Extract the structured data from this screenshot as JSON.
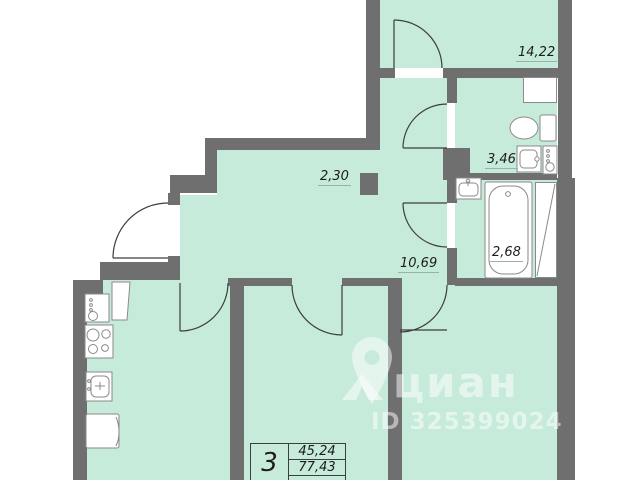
{
  "watermark": {
    "brand": "циан",
    "listing_id": "ID 325399024"
  },
  "labels": {
    "bedroom": "14,22",
    "corridor": "2,30",
    "wc": "3,46",
    "hall": "10,69",
    "bath": "2,68"
  },
  "stamp": {
    "rooms_count": "3",
    "row1": "45,24",
    "row2": "77,43"
  },
  "colors": {
    "room_fill": "#c7ebda",
    "wall": "#6f6f6f",
    "outline": "#3d3d3d",
    "fixture_stroke": "#8a8a8a",
    "label_text": "#1c1c1c",
    "watermark_white": "rgba(255,255,255,0.5)"
  },
  "icons": [
    "entry-door-arc",
    "bedroom-door-arc",
    "wc-door-arc",
    "bathroom-door-arc",
    "kitchen-door-arc",
    "room-door-arc",
    "toilet-icon",
    "wc-sink-icon",
    "water-heater-icon",
    "bath-sink-icon",
    "bathtub-icon",
    "vent-shaft-icon",
    "stove-icon",
    "kitchen-sink-icon",
    "fridge-icon",
    "boiler-icon",
    "cabinet-icon",
    "pin-icon"
  ]
}
